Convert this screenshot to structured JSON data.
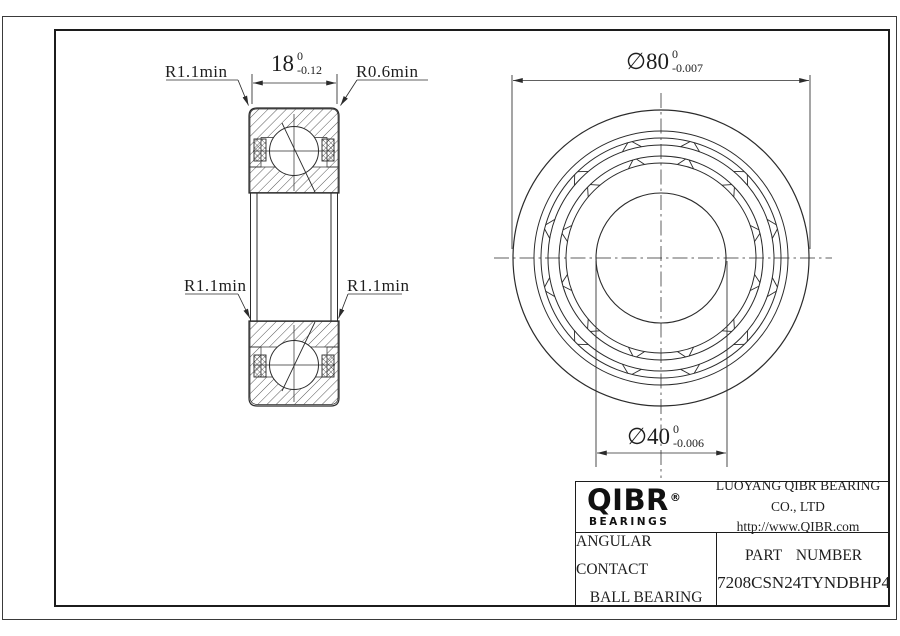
{
  "annotations": {
    "width_dim": {
      "value": "18",
      "tol_upper": "0",
      "tol_lower": "-0.12"
    },
    "outer_dia_dim": {
      "value": "∅80",
      "tol_upper": "0",
      "tol_lower": "-0.007"
    },
    "bore_dia_dim": {
      "value": "∅40",
      "tol_upper": "0",
      "tol_lower": "-0.006"
    },
    "radius_top_left": "R1.1min",
    "radius_top_right": "R0.6min",
    "radius_mid_left": "R1.1min",
    "radius_mid_right": "R1.1min"
  },
  "title_block": {
    "logo_text": "QIBR",
    "logo_registered": "®",
    "logo_subtext": "BEARINGS",
    "company_name": "LUOYANG QIBR BEARING CO., LTD",
    "website": "http://www.QIBR.com",
    "product_type_line1": "ANGULAR CONTACT",
    "product_type_line2": "BALL BEARING",
    "part_number_label": "PART NUMBER",
    "part_number": "7208CSN24TYNDBHP4"
  },
  "colors": {
    "line": "#2b2b2b",
    "background": "#ffffff"
  }
}
